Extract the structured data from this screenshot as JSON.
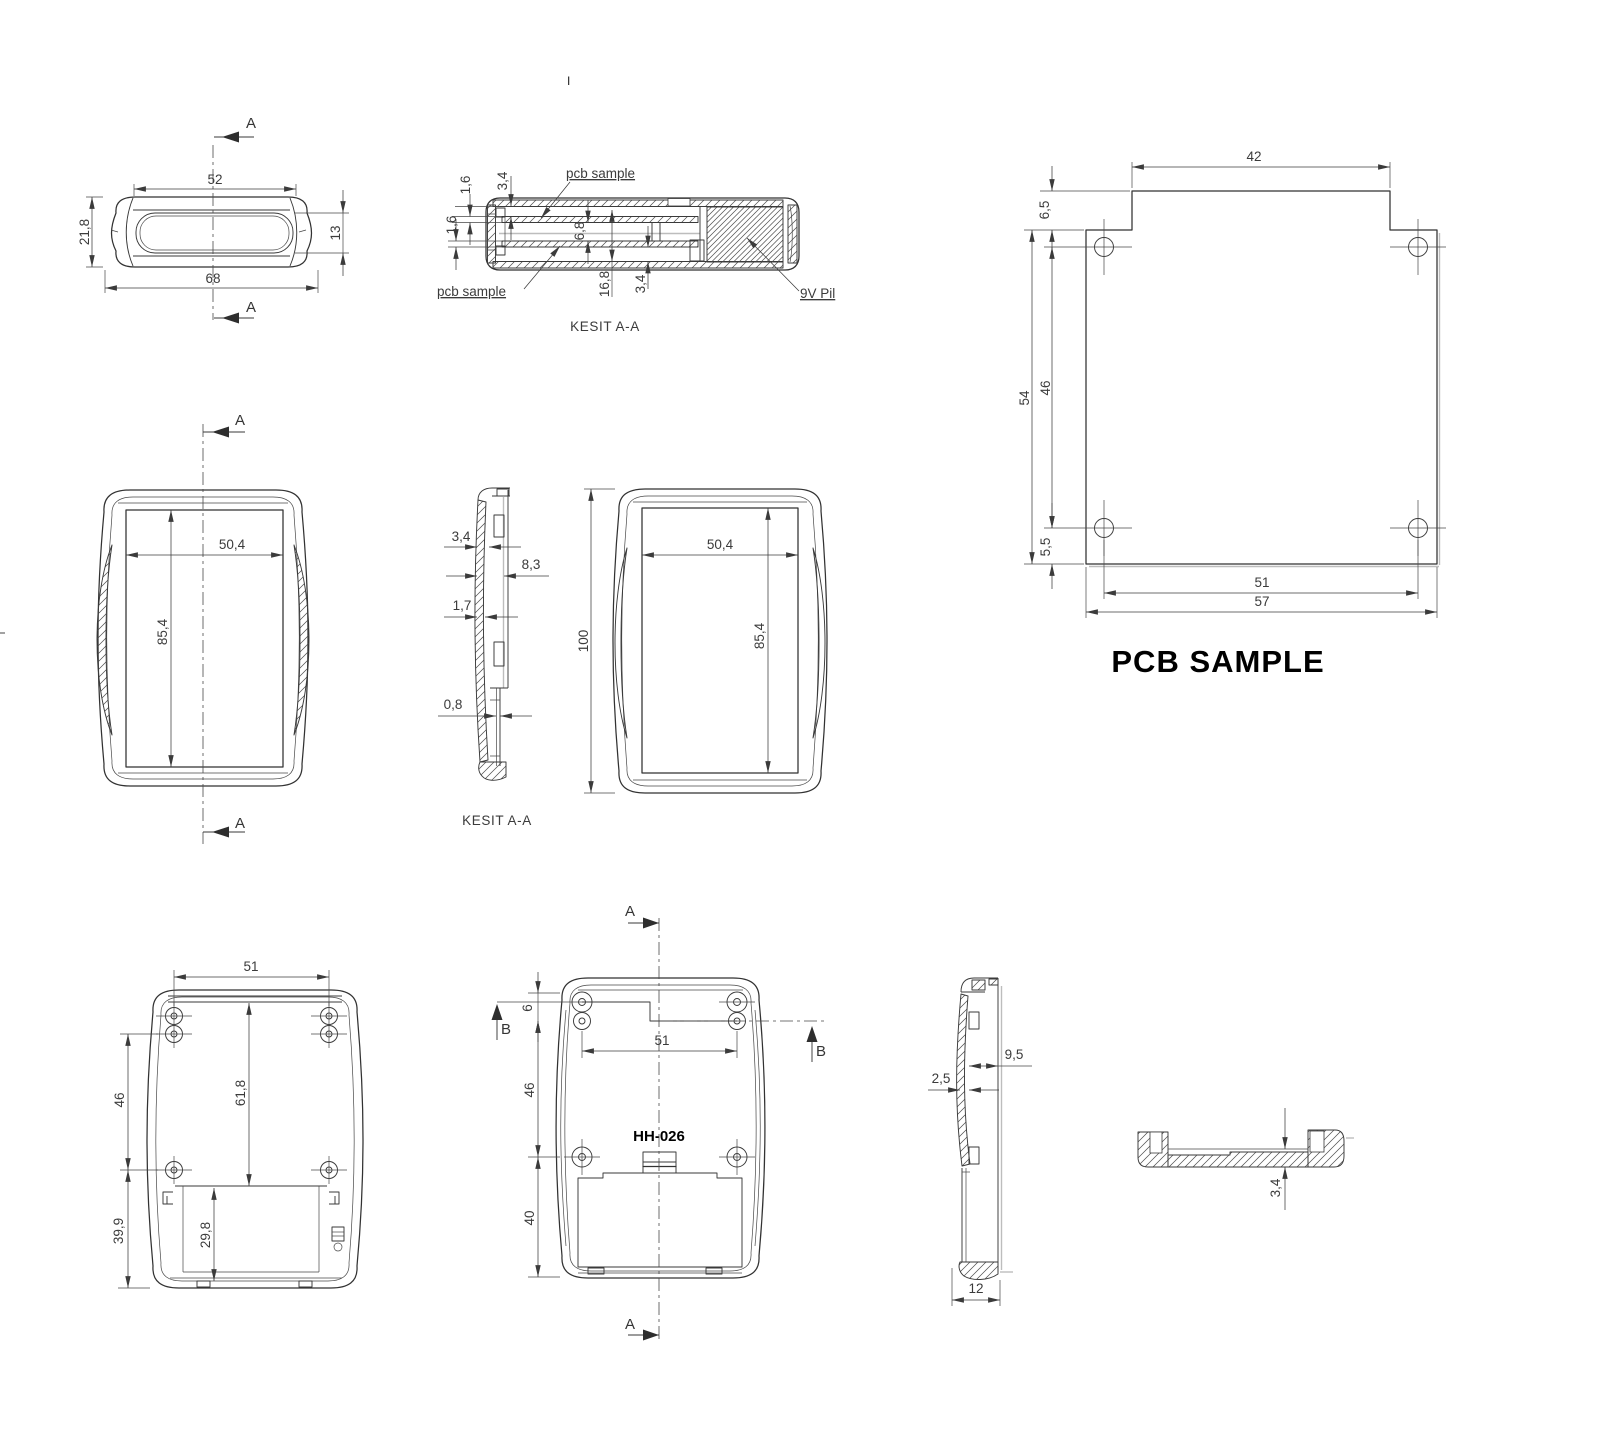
{
  "page": {
    "stray_mark": "I"
  },
  "markers": {
    "section_a": "A",
    "section_b": "B"
  },
  "top_view": {
    "dims": {
      "slot_width": "52",
      "height": "21,8",
      "slot_height": "13",
      "width": "68"
    }
  },
  "section_top": {
    "caption": "KESIT A-A",
    "labels": {
      "pcb_top": "pcb sample",
      "pcb_bottom": "pcb sample",
      "battery": "9V Pil"
    },
    "dims": {
      "lid_pcb_gap": "1,6",
      "rib_depth": "3,4",
      "base_pcb_gap": "1,6",
      "board_spacing": "6,8",
      "inner_depth": "16,8",
      "floor_gap": "3,4"
    }
  },
  "pcb": {
    "title": "PCB SAMPLE",
    "dims": {
      "top_width": "42",
      "notch_height": "6,5",
      "length": "54",
      "hole_span_v": "46",
      "hole_offset": "5,5",
      "hole_span_h": "51",
      "width": "57"
    }
  },
  "front_view": {
    "dims": {
      "inner_width": "50,4",
      "inner_height": "85,4"
    }
  },
  "section_side": {
    "caption": "KESIT A-A",
    "dims": {
      "wall": "3,4",
      "depth": "8,3",
      "lip": "1,7",
      "gap": "0,8"
    }
  },
  "front_view_right": {
    "dims": {
      "height": "100",
      "inner_width": "50,4",
      "inner_height": "85,4"
    }
  },
  "inside_view": {
    "dims": {
      "boss_span": "51",
      "boss_v": "46",
      "inner_span": "61,8",
      "bottom_span": "39,9",
      "battery_depth": "29,8"
    }
  },
  "back_view": {
    "model": "HH-026",
    "dims": {
      "step": "6",
      "boss_span": "51",
      "boss_v": "46",
      "battery_v": "40"
    }
  },
  "side_view_bottom": {
    "dims": {
      "depth": "9,5",
      "wall": "2,5",
      "base": "12"
    }
  },
  "section_detail": {
    "dims": {
      "floor": "3,4"
    }
  }
}
